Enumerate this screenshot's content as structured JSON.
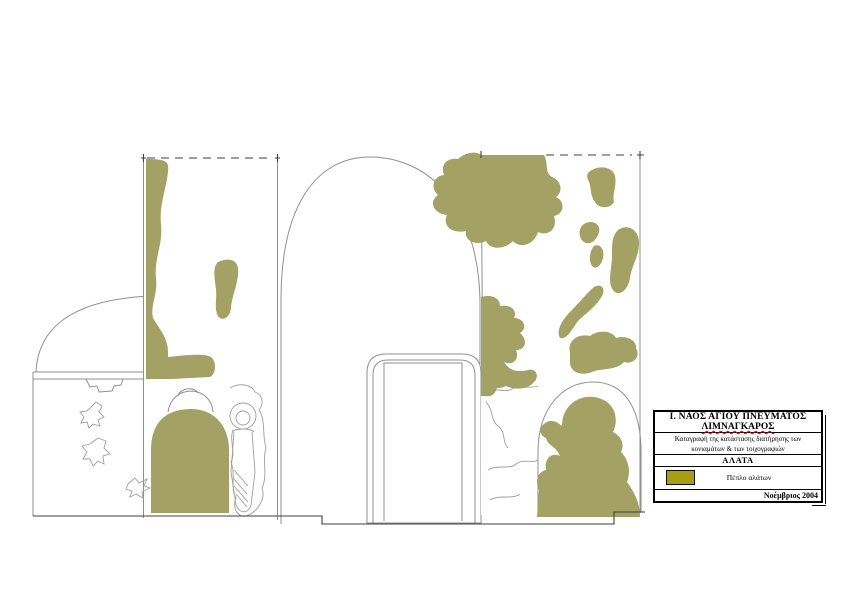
{
  "colors": {
    "salt_veil": "#a4a164",
    "legend_swatch": "#a89f10",
    "wall_line": "#8f8f8f",
    "fresco_line": "#9f9f9f",
    "datum_line": "#3f3f3f",
    "spellcheck_underline": "#e00000"
  },
  "title_block": {
    "title_line1": "Ι. ΝΑΟΣ ΑΓΙΟΥ ΠΝΕΥΜΑΤΟΣ",
    "title_line2": "ΛΙΜΝΑΓΚΑΡΟΣ",
    "description_line1": "Καταγραφή της κατάστασης διατήρησης των",
    "description_line2": "κονιαμάτων & των τοιχογραφιών",
    "section_header": "ΑΛΑΤΑ",
    "legend": {
      "label": "Πέπλο αλάτων",
      "swatch_color": "#a89f10"
    },
    "date": "Νοέμβριος 2004"
  }
}
